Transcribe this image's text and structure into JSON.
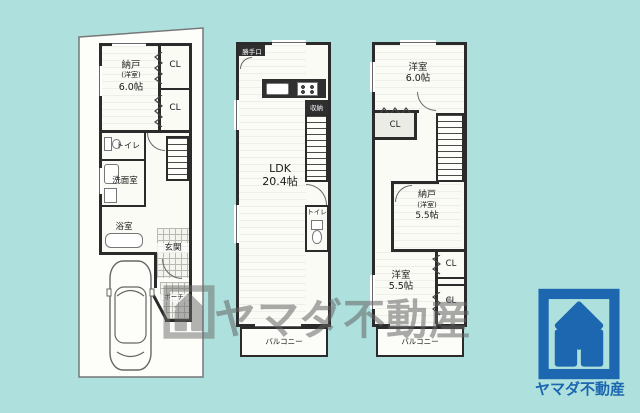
{
  "colors": {
    "background": "#aee1de",
    "wall": "#2b2b2b",
    "floor": "#fbfbf6",
    "brand_blue": "#1c67b0",
    "watermark_gray": "#646464"
  },
  "floor1": {
    "storage_room": {
      "name": "納戸",
      "sub": "(洋室)",
      "size": "6.0帖"
    },
    "closet_top": "CL",
    "closet_bottom": "CL",
    "toilet": "トイレ",
    "washroom": "洗面室",
    "bathroom": "浴室",
    "entrance": "玄関",
    "porch": "ポーチ"
  },
  "floor2": {
    "back_door": "勝手口",
    "storage": "収納",
    "ldk": {
      "name": "LDK",
      "size": "20.4帖"
    },
    "toilet": "トイレ",
    "balcony": "バルコニー"
  },
  "floor3": {
    "bedroom_top": {
      "name": "洋室",
      "size": "6.0帖"
    },
    "closet_1": "CL",
    "storage_room": {
      "name": "納戸",
      "sub": "(洋室)",
      "size": "5.5帖"
    },
    "closet_2": "CL",
    "bedroom_bottom": {
      "name": "洋室",
      "size": "5.5帖"
    },
    "closet_3": "CL",
    "balcony": "バルコニー"
  },
  "watermark": {
    "text": "ヤマダ不動産"
  },
  "brand": {
    "name": "ヤマダ不動産"
  }
}
